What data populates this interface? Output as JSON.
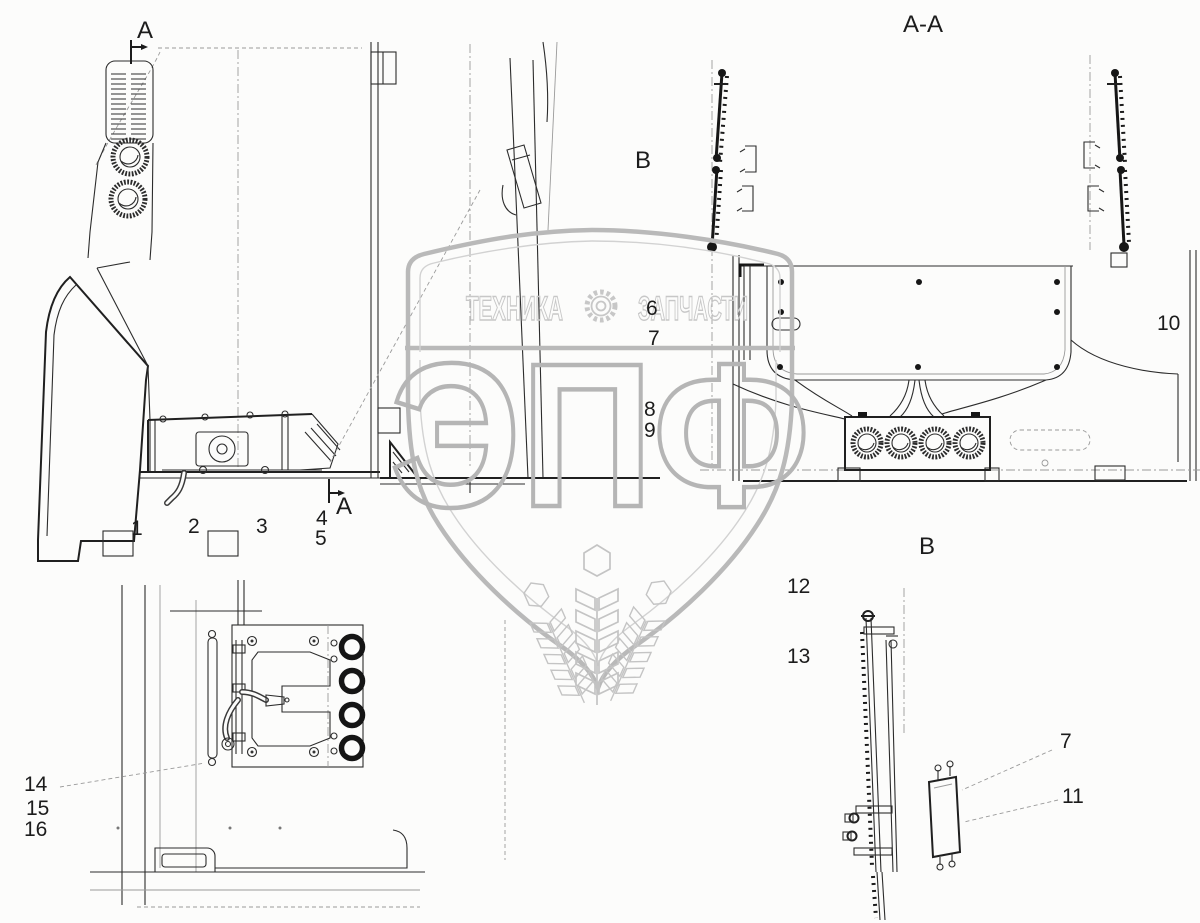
{
  "page": {
    "background": "#fcfcfb",
    "line_color": "#2c2c2c",
    "watermark_color": "#b9b9b9"
  },
  "watermark": {
    "banner_left": "ТЕХНИКА",
    "banner_right": "ЗАПЧАСТИ",
    "monogram": "ЭПФ",
    "gear_icon": "gear-icon",
    "wheat_icon": "wheat-ear-icon"
  },
  "section_labels": {
    "cut_top": "A",
    "section_view": "A-A",
    "view_b_marker": "B",
    "cut_bottom": "A",
    "view_b_title": "B"
  },
  "callouts": {
    "c1": "1",
    "c2": "2",
    "c3": "3",
    "c4": "4",
    "c5": "5",
    "c6": "6",
    "c7": "7",
    "c7_dup": "7",
    "c8": "8",
    "c9": "9",
    "c10": "10",
    "c11": "11",
    "c12": "12",
    "c13": "13",
    "c14": "14",
    "c15": "15",
    "c16": "16"
  }
}
